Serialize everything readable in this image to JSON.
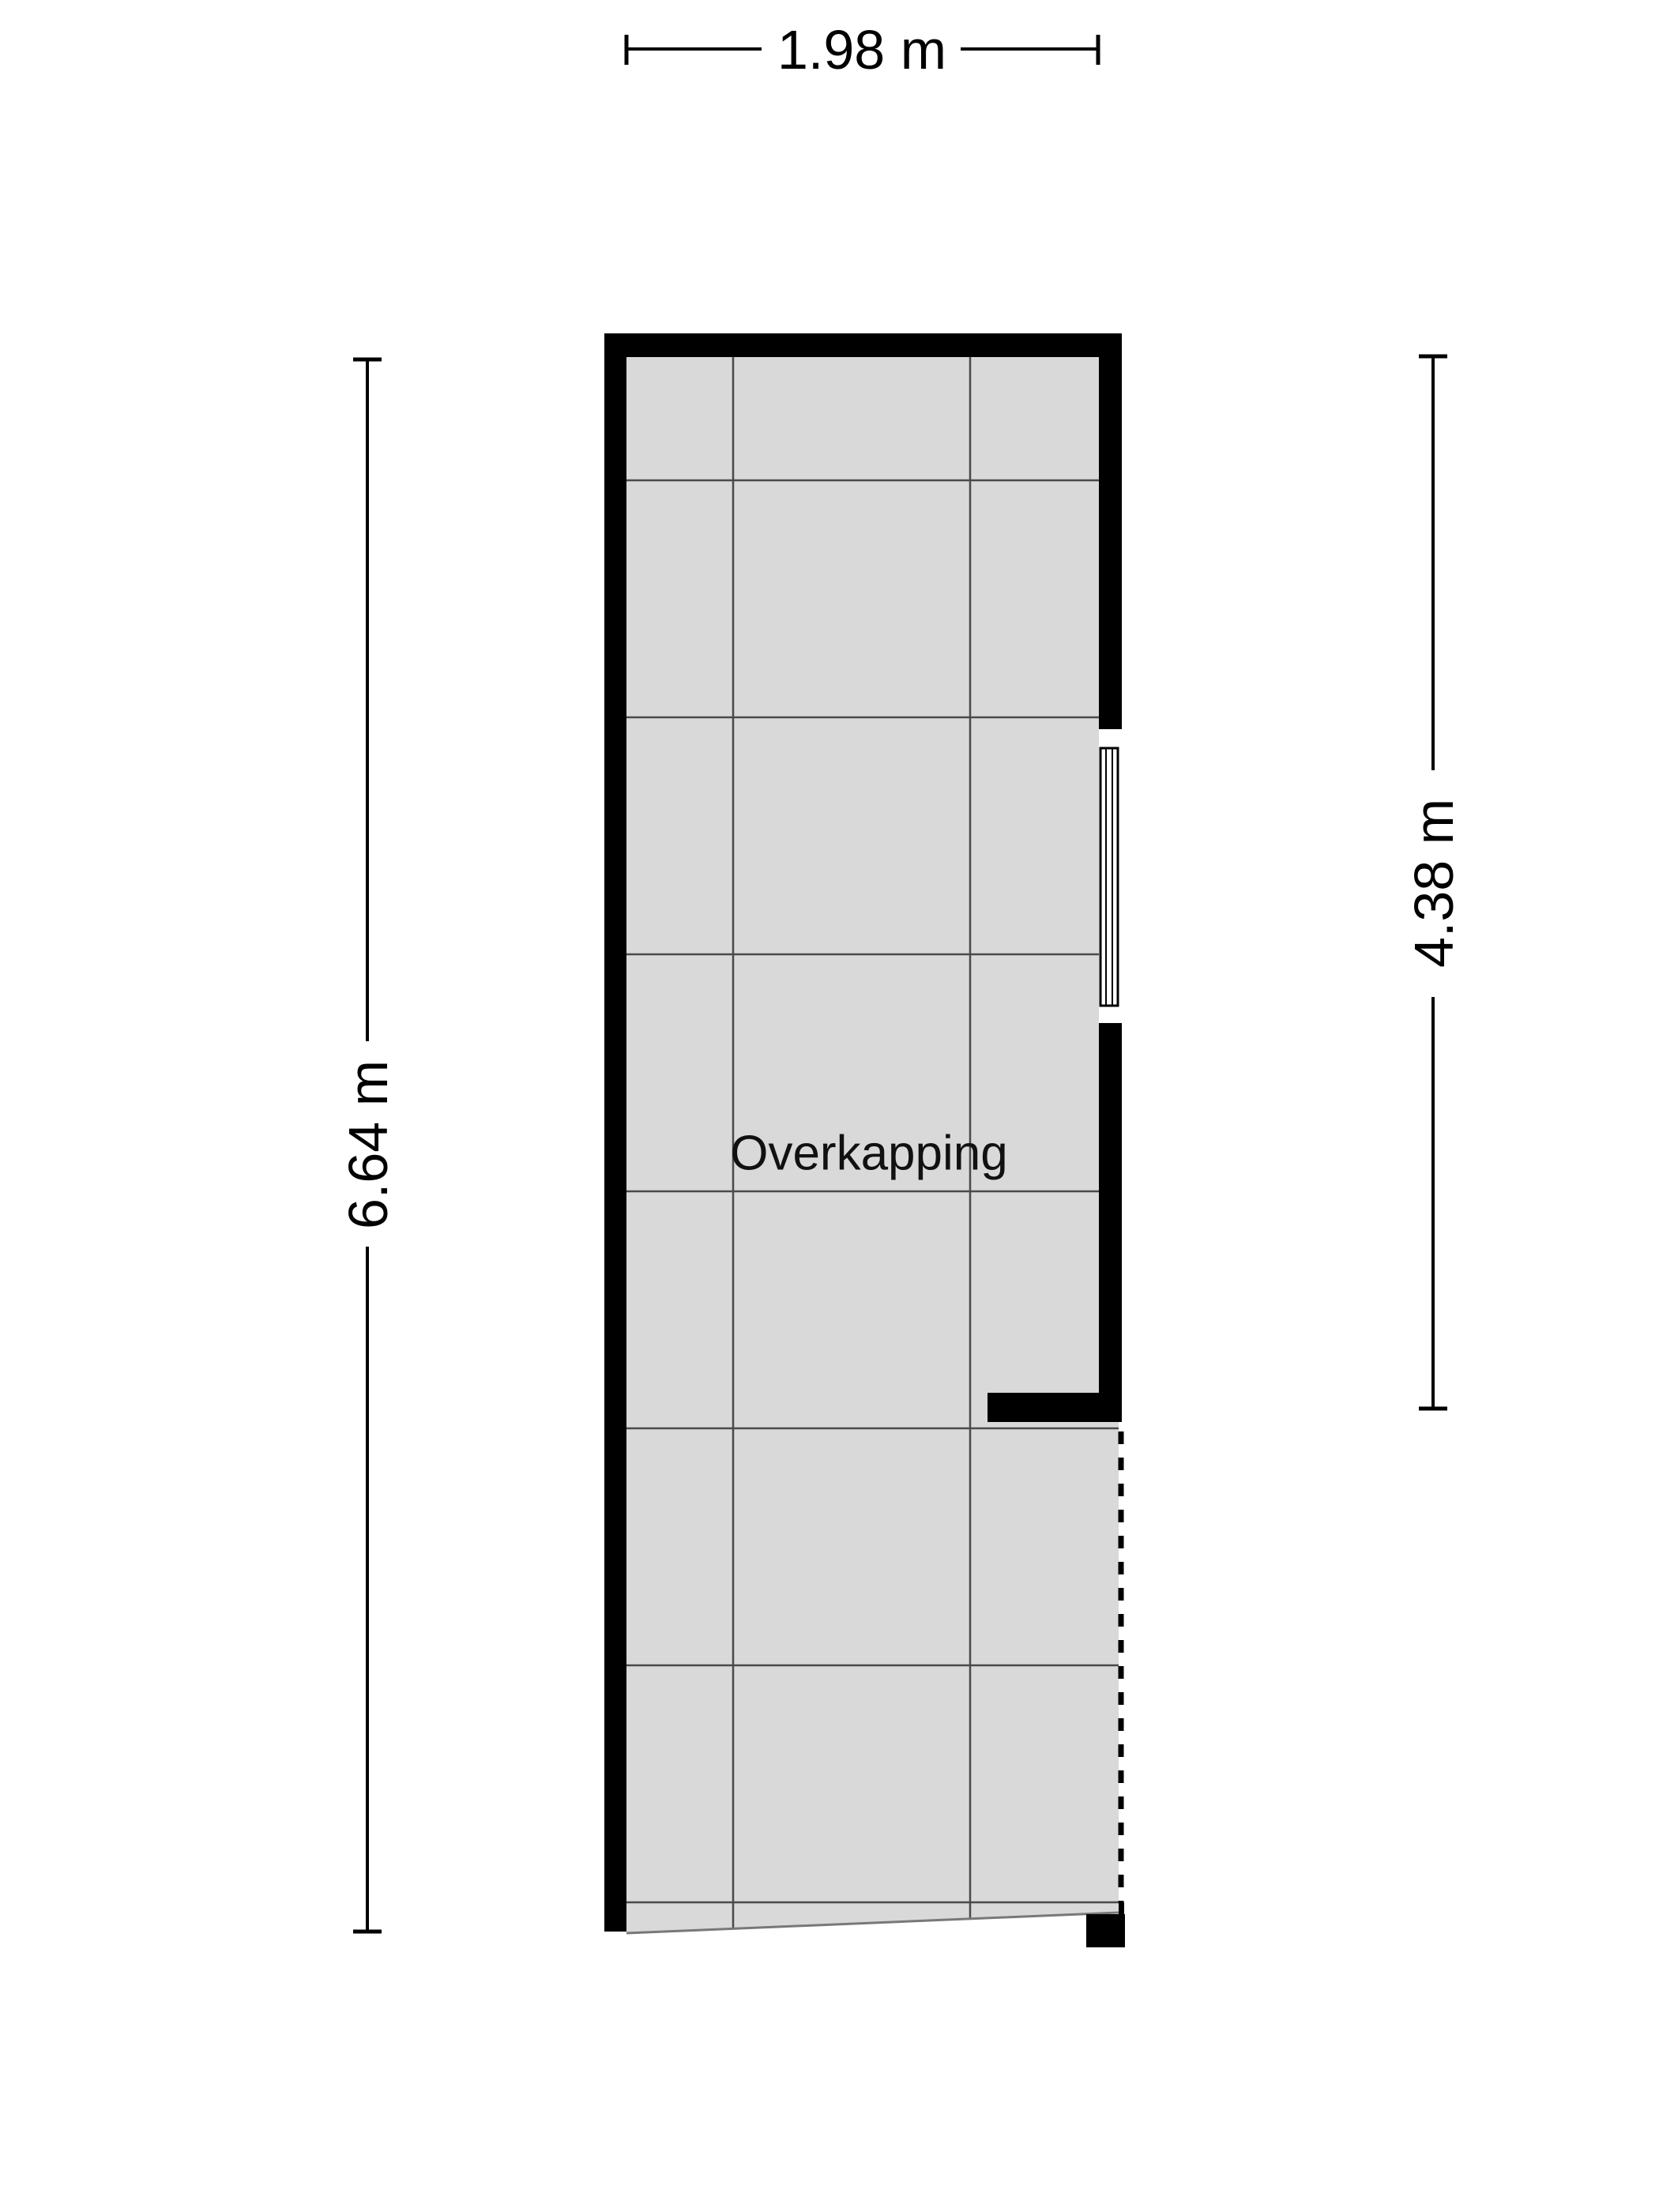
{
  "page": {
    "background_color": "#ffffff"
  },
  "plan": {
    "room_label": "Overkapping",
    "floor_color": "#d9d9d9",
    "wall_color": "#000000",
    "grid_color": "#4a4a4a",
    "text_color": "#111111",
    "dimension_color": "#000000"
  },
  "dimensions": {
    "top": {
      "label": "1.98 m",
      "orientation": "horizontal"
    },
    "left": {
      "label": "6.64 m",
      "orientation": "vertical"
    },
    "right": {
      "label": "4.38 m",
      "orientation": "vertical"
    }
  }
}
